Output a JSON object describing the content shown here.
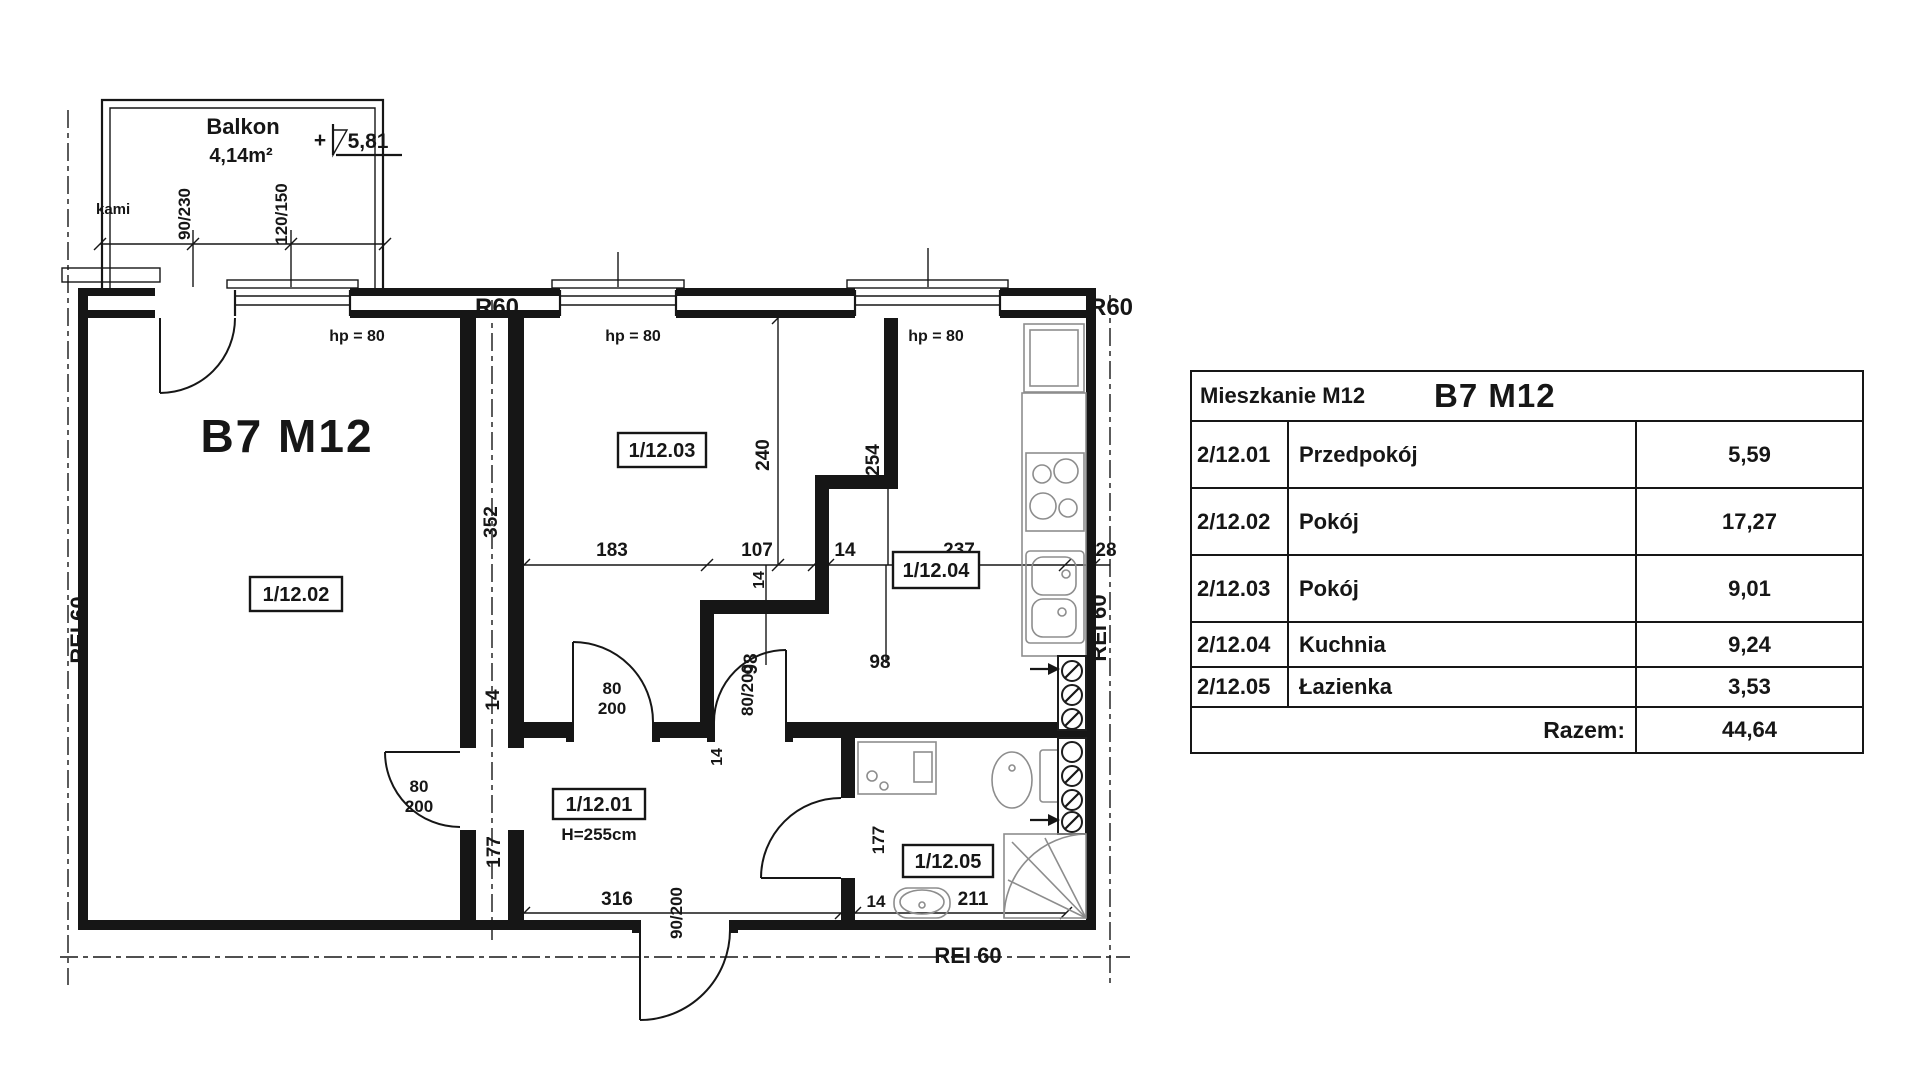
{
  "plan": {
    "title": "B7 M12",
    "balcony": {
      "name": "Balkon",
      "area": "4,14m²",
      "level_prefix": "+",
      "level": "5,81",
      "side_label": "kami"
    },
    "sills": {
      "s1": "hp = 80",
      "s2": "hp = 80",
      "s3": "hp = 80"
    },
    "fire": {
      "r60_a": "R60",
      "r60_b": "R60",
      "rei_left": "REI 60",
      "rei_right": "REI 60",
      "rei_bottom": "REI 60"
    },
    "rooms": {
      "r02": "1/12.02",
      "r03": "1/12.03",
      "r04": "1/12.04",
      "r01": "1/12.01",
      "r05": "1/12.05",
      "r01_height": "H=255cm"
    },
    "dims": {
      "balcony_door": "90/230",
      "balcony_window": "120/150",
      "d183": "183",
      "d107": "107",
      "d14_wall": "14",
      "d237": "237",
      "d28": "28",
      "d240": "240",
      "d254": "254",
      "d352": "352",
      "d14_joint": "14",
      "d177_joint": "177",
      "d98_a": "98",
      "d98_b": "98",
      "d14_niche": "14",
      "d14_hall": "14",
      "d316": "316",
      "d90_200": "90/200",
      "d80": "80",
      "d200": "200",
      "d80_200": "80/200",
      "d14_bath": "14",
      "d211": "211",
      "d177_bath": "177"
    }
  },
  "table": {
    "header_left": "Mieszkanie M12",
    "header_title": "B7 M12",
    "rows": [
      {
        "code": "2/12.01",
        "name": "Przedpokój",
        "area": "5,59"
      },
      {
        "code": "2/12.02",
        "name": "Pokój",
        "area": "17,27"
      },
      {
        "code": "2/12.03",
        "name": "Pokój",
        "area": "9,01"
      },
      {
        "code": "2/12.04",
        "name": "Kuchnia",
        "area": "9,24"
      },
      {
        "code": "2/12.05",
        "name": "Łazienka",
        "area": "3,53"
      }
    ],
    "total_label": "Razem:",
    "total_value": "44,64"
  }
}
